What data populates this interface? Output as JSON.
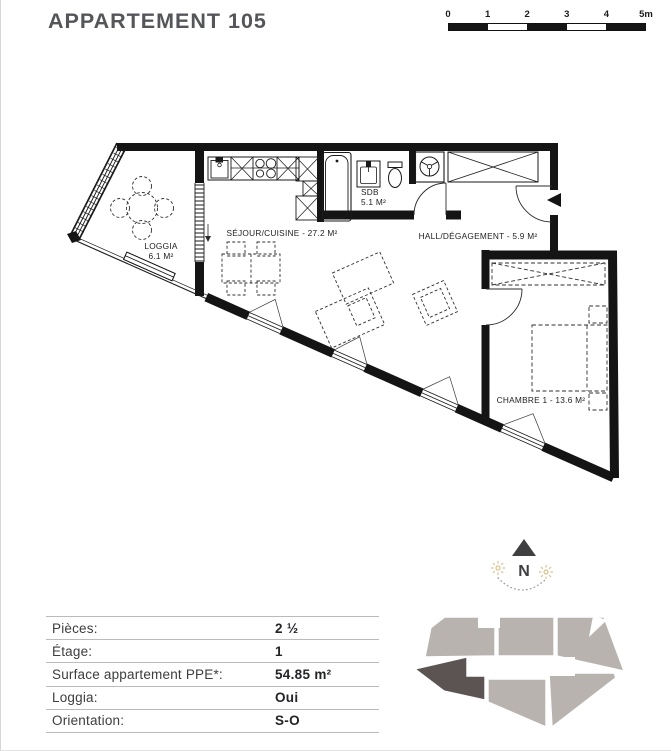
{
  "header": {
    "title": "APPARTEMENT 105"
  },
  "scale_bar": {
    "ticks": [
      "0",
      "1",
      "2",
      "3",
      "4",
      "5m"
    ]
  },
  "rooms": {
    "loggia": {
      "name": "LOGGIA",
      "area": "6.1 M²"
    },
    "sejour": {
      "label": "SÉJOUR/CUISINE - 27.2 M²"
    },
    "sdb": {
      "name": "SDB",
      "area": "5.1 M²"
    },
    "hall": {
      "label": "HALL/DÉGAGEMENT - 5.9 M²"
    },
    "chambre": {
      "label": "CHAMBRE 1 - 13.6 M²"
    }
  },
  "compass": {
    "north_label": "N"
  },
  "details": {
    "rows": [
      {
        "label": "Pièces:",
        "value": "2 ½"
      },
      {
        "label": "Étage:",
        "value": "1"
      },
      {
        "label": "Surface appartement PPE*:",
        "value": "54.85 m²"
      },
      {
        "label": "Loggia:",
        "value": "Oui"
      },
      {
        "label": "Orientation:",
        "value": "S-O"
      }
    ]
  },
  "colors": {
    "wall": "#141414",
    "map_unit_gray": "#b9b3b0",
    "map_unit_highlight": "#5c5452",
    "compass_star_beige": "#d8c08e",
    "title_gray": "#55565a"
  }
}
